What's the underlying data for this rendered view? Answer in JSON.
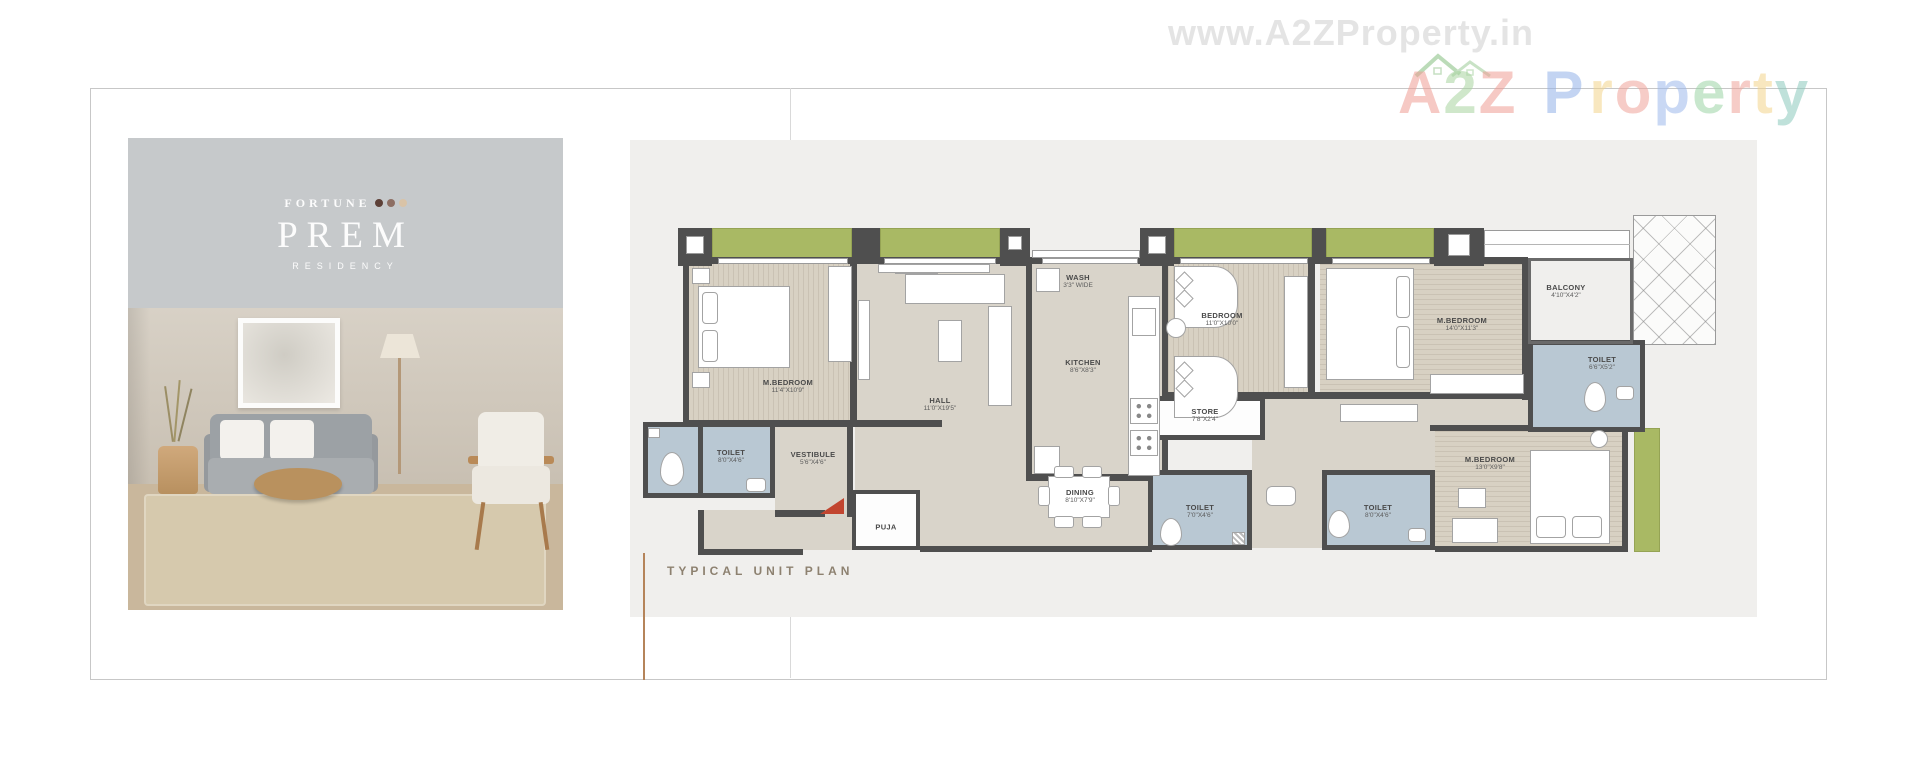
{
  "watermark": {
    "url_text": "www.A2ZProperty.in",
    "a2z": [
      {
        "ch": "A",
        "color": "#ef9d94"
      },
      {
        "ch": "2",
        "color": "#a8d4a0"
      },
      {
        "ch": "Z",
        "color": "#ef9d94"
      }
    ],
    "property": [
      {
        "ch": "P",
        "color": "#93b2e8"
      },
      {
        "ch": "r",
        "color": "#f4d48c"
      },
      {
        "ch": "o",
        "color": "#f0a49b"
      },
      {
        "ch": "p",
        "color": "#9db9ec"
      },
      {
        "ch": "e",
        "color": "#9cd4a6"
      },
      {
        "ch": "r",
        "color": "#f0a49b"
      },
      {
        "ch": "t",
        "color": "#f4d48c"
      },
      {
        "ch": "y",
        "color": "#8cc9bd"
      }
    ]
  },
  "brand": {
    "line1": "FORTUNE",
    "name": "PREM",
    "line3": "RESIDENCY",
    "dot_colors": [
      "#5d4037",
      "#8d6e63",
      "#d9c3a7"
    ]
  },
  "plan": {
    "caption": "TYPICAL UNIT PLAN",
    "rooms": [
      {
        "name": "M.BEDROOM",
        "dim": "11'4\"X10'9\""
      },
      {
        "name": "HALL",
        "dim": "11'0\"X19'5\""
      },
      {
        "name": "WASH",
        "dim": "3'3\" WIDE"
      },
      {
        "name": "KITCHEN",
        "dim": "8'6\"X8'3\""
      },
      {
        "name": "BEDROOM",
        "dim": "11'0\"X10'0\""
      },
      {
        "name": "STORE",
        "dim": "7'8\"X2'4\""
      },
      {
        "name": "M.BEDROOM",
        "dim": "14'0\"X11'3\""
      },
      {
        "name": "BALCONY",
        "dim": "4'10\"X4'2\""
      },
      {
        "name": "TOILET",
        "dim": "6'6\"X5'2\""
      },
      {
        "name": "TOILET",
        "dim": "8'0\"X4'6\""
      },
      {
        "name": "VESTIBULE",
        "dim": "5'6\"X4'6\""
      },
      {
        "name": "PUJA",
        "dim": ""
      },
      {
        "name": "DINING",
        "dim": "8'10\"X7'9\""
      },
      {
        "name": "TOILET",
        "dim": "7'0\"X4'6\""
      },
      {
        "name": "TOILET",
        "dim": "8'0\"X4'6\""
      },
      {
        "name": "M.BEDROOM",
        "dim": "13'0\"X9'8\""
      }
    ]
  },
  "colors": {
    "balcony_green": "#a9b964",
    "wall_dark": "#4f4f4f",
    "toilet_blue": "#b9c8d3",
    "balcony_tan": "#c9a283",
    "floor_beige": "#d9d4ca",
    "accent_line": "#b5845a",
    "caption_text": "#8d8170",
    "entrance_door_red": "#c2452f",
    "panel_gray": "#f0efed",
    "brand_bg_gray": "#c6c9cb"
  }
}
